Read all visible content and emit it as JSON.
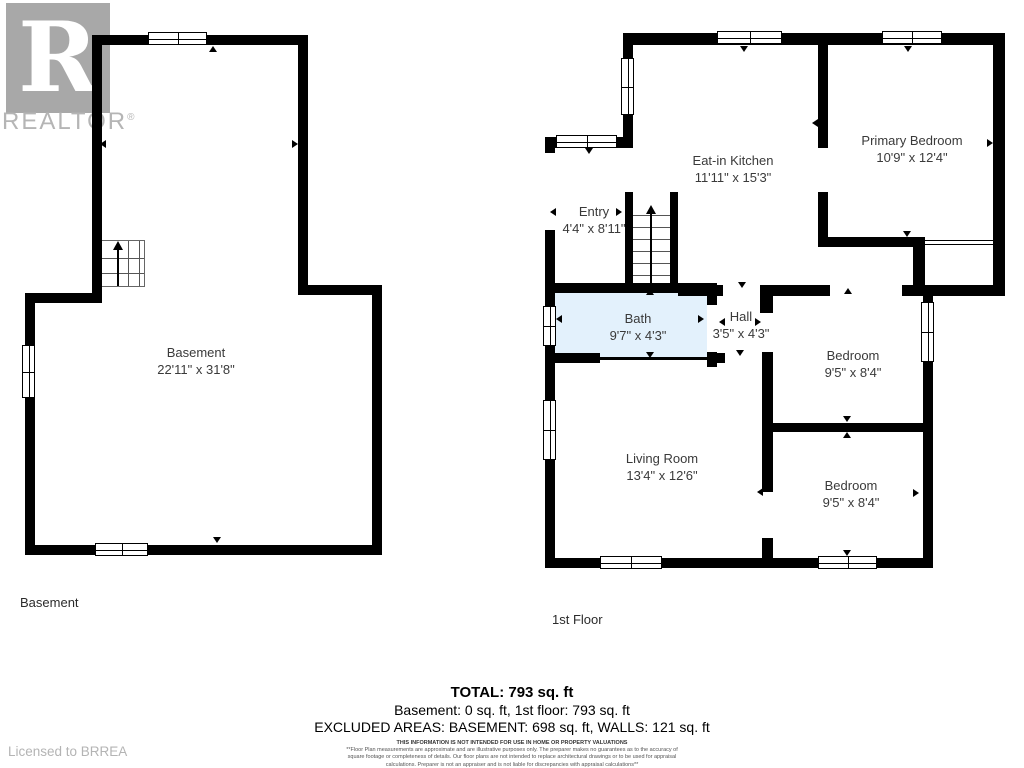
{
  "watermark": {
    "logo_letter": "R",
    "logo_text": "REALTOR",
    "registered_symbol": "®"
  },
  "floors": {
    "basement": {
      "caption": "Basement",
      "rooms": [
        {
          "name": "Basement",
          "dims": "22'11\" x 31'8\""
        }
      ]
    },
    "first": {
      "caption": "1st Floor",
      "rooms": [
        {
          "name": "Entry",
          "dims": "4'4\" x 8'11\""
        },
        {
          "name": "Eat-in Kitchen",
          "dims": "11'11\" x 15'3\""
        },
        {
          "name": "Primary Bedroom",
          "dims": "10'9\" x 12'4\""
        },
        {
          "name": "Bath",
          "dims": "9'7\" x 4'3\""
        },
        {
          "name": "Hall",
          "dims": "3'5\" x 4'3\""
        },
        {
          "name": "Bedroom",
          "dims": "9'5\" x 8'4\""
        },
        {
          "name": "Living Room",
          "dims": "13'4\" x 12'6\""
        },
        {
          "name": "Bedroom",
          "dims": "9'5\" x 8'4\""
        }
      ]
    }
  },
  "summary": {
    "total": "TOTAL: 793 sq. ft",
    "floor_areas": "Basement: 0 sq. ft, 1st floor: 793 sq. ft",
    "excluded_areas": "EXCLUDED AREAS: BASEMENT: 698 sq. ft, WALLS: 121 sq. ft",
    "disclaimer_title": "THIS INFORMATION IS NOT INTENDED FOR USE IN HOME OR PROPERTY VALUATIONS",
    "disclaimer_body": "**Floor Plan measurements are approximate and are illustrative purposes only. The preparer makes no guarantees as to the accuracy of square footage or completeness of details. Our floor plans are not intended to replace architectural drawings or to be used for appraisal calculations. Preparer is not an appraiser and is not liable for discrepancies with appraisal calculations**",
    "disclaimer_footnote": "SIZES AND DIMENSIONS ARE APPROXIMATE, ACTUAL MAY VARY"
  },
  "license": "Licensed to BRREA",
  "colors": {
    "wall": "#000000",
    "bath_fill": "#e3f1fc",
    "label": "#3a3a3a",
    "watermark_gray": "#a8a8a8"
  }
}
